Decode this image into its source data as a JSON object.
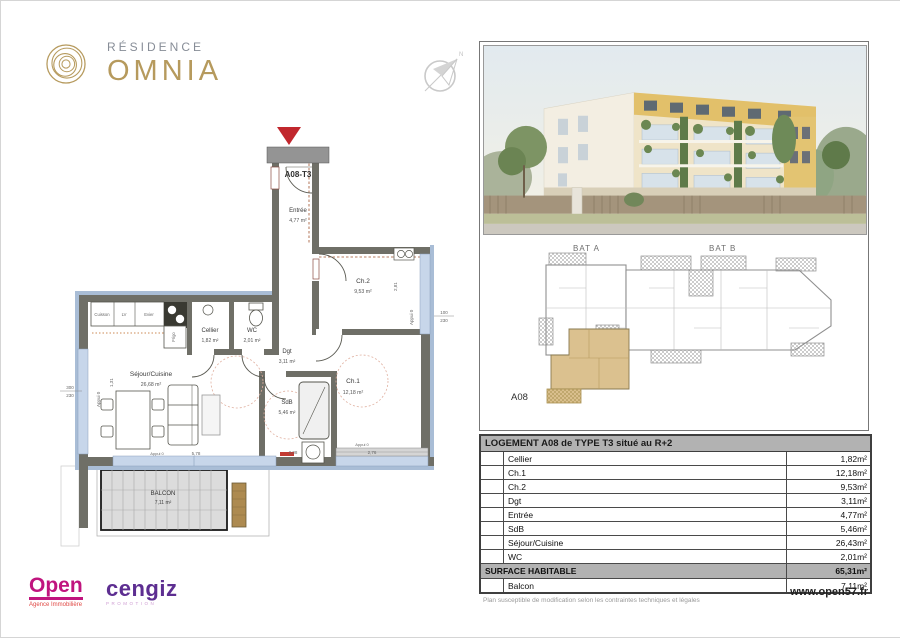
{
  "brand": {
    "residence": "RÉSIDENCE",
    "name": "OMNIA"
  },
  "compass": {
    "north": "N"
  },
  "floorplan": {
    "unit_tag": "A08-T3",
    "rooms": {
      "entree": {
        "name": "Entrée",
        "area": "4,77 m²"
      },
      "ch2": {
        "name": "Ch.2",
        "area": "9,53 m²"
      },
      "cellier": {
        "name": "Cellier",
        "area": "1,82 m²"
      },
      "wc": {
        "name": "WC",
        "area": "2,01 m²"
      },
      "dgt": {
        "name": "Dgt",
        "area": "3,11 m²"
      },
      "ch1": {
        "name": "Ch.1",
        "area": "12,18 m²"
      },
      "sdb": {
        "name": "SdB",
        "area": "5,46 m²"
      },
      "sejour": {
        "name": "Séjour/Cuisine",
        "area": "26,68 m²"
      },
      "balcon": {
        "name": "BALCON",
        "area": "7,11 m²"
      }
    },
    "kitchen": {
      "cuisson": "Cuisson",
      "lv": "LV",
      "evier": "Evier",
      "frigo": "Frigo"
    },
    "dims": {
      "left_w": "300",
      "left_h": "230",
      "right_w": "100",
      "right_h": "230",
      "appui": "Appui 0",
      "sejour_width": "5,78",
      "sdb_width": "2,08",
      "ch1_width": "2,76",
      "ch2_height": "2,81",
      "left_window": "1,31"
    }
  },
  "keyplan": {
    "bat_a": "BAT A",
    "bat_b": "BAT B",
    "unit": "A08"
  },
  "table": {
    "title": "LOGEMENT A08 de TYPE T3 situé au R+2",
    "rows": [
      {
        "label": "Cellier",
        "value": "1,82m²"
      },
      {
        "label": "Ch.1",
        "value": "12,18m²"
      },
      {
        "label": "Ch.2",
        "value": "9,53m²"
      },
      {
        "label": "Dgt",
        "value": "3,11m²"
      },
      {
        "label": "Entrée",
        "value": "4,77m²"
      },
      {
        "label": "SdB",
        "value": "5,46m²"
      },
      {
        "label": "Séjour/Cuisine",
        "value": "26,43m²"
      },
      {
        "label": "WC",
        "value": "2,01m²"
      }
    ],
    "total": {
      "label": "SURFACE HABITABLE",
      "value": "65,31m²"
    },
    "annex": {
      "label": "Balcon",
      "value": "7,11m²"
    }
  },
  "logos": {
    "open": {
      "name": "Open",
      "tagline": "Agence Immobilière"
    },
    "cengiz": {
      "name": "cengiz",
      "tagline": "PROMOTION"
    }
  },
  "footer": {
    "disclaimer": "Plan susceptible de modification selon les contraintes techniques et légales",
    "website": "www.open57.fr"
  },
  "colors": {
    "gold": "#b69a5d",
    "open_magenta": "#c0147e",
    "cengiz_purple": "#5d2e91",
    "unit_highlight": "#dbc18f",
    "wall_gray": "#6f6f67",
    "exterior_blue": "#a9bdd6",
    "window_blue": "#c7d6ea",
    "entry_red": "#c1272d"
  }
}
